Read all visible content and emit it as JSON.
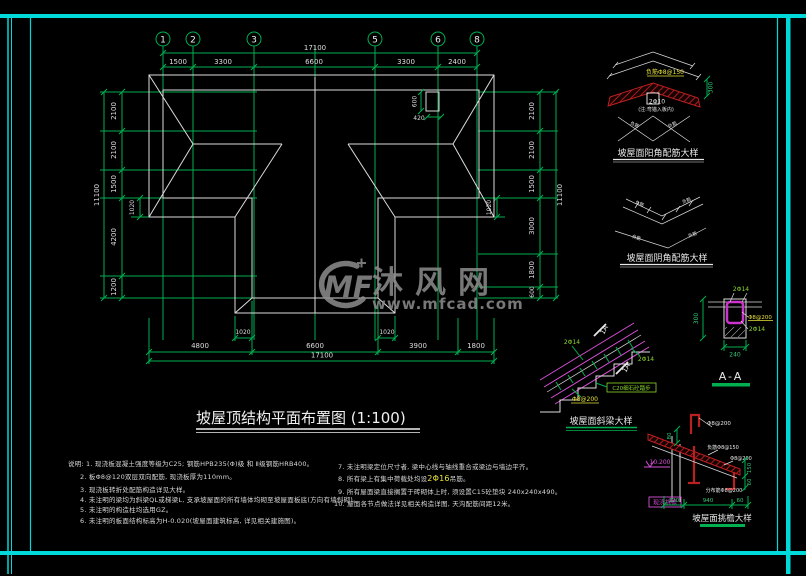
{
  "watermark": {
    "logo": "MF",
    "brand": "沐风网",
    "url": "www.mfcad.com"
  },
  "plan": {
    "title": "坡屋顶结构平面布置图 (1:100)",
    "axes": {
      "bubbles": [
        "1",
        "2",
        "3",
        "5",
        "6",
        "8"
      ]
    },
    "dims": {
      "top_total": "17100",
      "top_segments": [
        "1500",
        "3300",
        "6600",
        "3300",
        "2400"
      ],
      "left": [
        "2100",
        "2100",
        "1500",
        "4200",
        "1200"
      ],
      "left_total": "11100",
      "left_offset": "1020",
      "right": [
        "2100",
        "2100",
        "1500",
        "3000",
        "1800",
        "600"
      ],
      "right_total": "11100",
      "right_offset": "1020",
      "bottom_offsets": [
        "1020",
        "1020"
      ],
      "bottom_segments": [
        "4800",
        "6600",
        "3900",
        "1800"
      ],
      "bottom_total": "17100",
      "chimney_h": "600",
      "chimney_w": "420"
    }
  },
  "details": {
    "yang": {
      "title": "坡屋面阳角配筋大样",
      "top_label": "负筋Φ8@150",
      "mid_label": "2Φ10",
      "note": "(注:弯锚入板内)",
      "dim": "300",
      "diag_label": "负筋"
    },
    "yin": {
      "title": "坡屋面阴角配筋大样",
      "diag_label": "负筋"
    },
    "beam": {
      "title": "坡屋面斜梁大样",
      "bar_label": "2Φ14",
      "bar_label2": "2Φ14",
      "cut": "1A",
      "cut2": "1A",
      "step_label": "C20细石砼踏步",
      "stirrup": "Φ8@200"
    },
    "section": {
      "title": "A-A",
      "top_bar": "2Φ14",
      "stirrup": "Φ8@200",
      "bot_bar": "2Φ14",
      "h": "300",
      "w": "240"
    },
    "eave": {
      "title": "坡屋面挑檐大样",
      "l1": "Φ8@200",
      "l2": "负筋Φ8@150",
      "l3": "Φ8@200",
      "l4": "分布筋Φ8@200",
      "tag": "现浇挑檐",
      "elev": "10.200",
      "d80": "80",
      "d120": "120",
      "d940": "940",
      "d60": "60",
      "r150": "150",
      "r60": "60"
    }
  },
  "notes": {
    "left": [
      "说明: 1. 现浇板混凝土强度等级为C25; 钢筋HPB235(Φ)级 和 Ⅱ级钢筋HRB400。",
      "2. 板Φ8@120双层双向配筋, 现浇板厚为110mm。",
      "3. 现浇板转折处配筋构造详见大样。",
      "4. 未注明的梁均为斜梁QL或梯梁L, 支承坡屋面的所有墙体均砌至坡屋面板底(方向有墙斜砌)。",
      "5. 未注明的构造柱均选用GZ。",
      "6. 未注明的板面结构标高为H-0.020(坡屋面建筑标高, 详见相关建施图)。"
    ],
    "right": [
      "7. 未注明梁定位尺寸者, 梁中心线与轴线重合或梁边与墙边平齐。",
      {
        "p": "8. 所有梁上有集中荷载处均设",
        "h": "2Φ16",
        "s": "吊筋。"
      },
      "9. 所有屋面梁直接搁置于砖砌体上时, 须设置C15砼垫块 240x240x490。",
      "10. 屋面各节点做法详见相关构造详图, 天沟配筋间距12米。"
    ]
  }
}
